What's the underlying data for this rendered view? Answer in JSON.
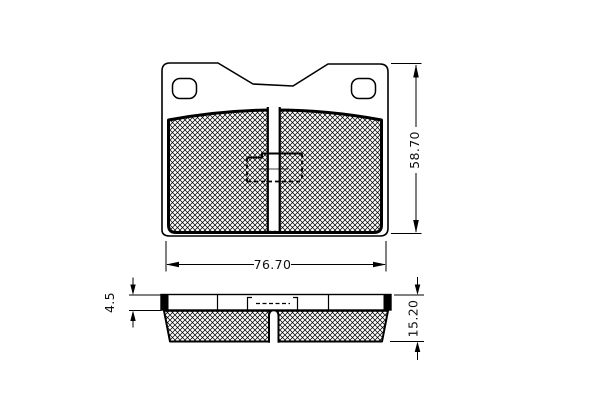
{
  "page": {
    "background_color": "#ffffff",
    "line_color": "#000000"
  },
  "drawing": {
    "kind": "technical-drawing",
    "subject": "disc-brake-pad",
    "views": [
      "front-view",
      "side-profile-view"
    ],
    "dimensions": {
      "pad_width": "76.70",
      "pad_height": "58.70",
      "plate_thickness": "4.5",
      "total_thickness": "15.20"
    }
  }
}
